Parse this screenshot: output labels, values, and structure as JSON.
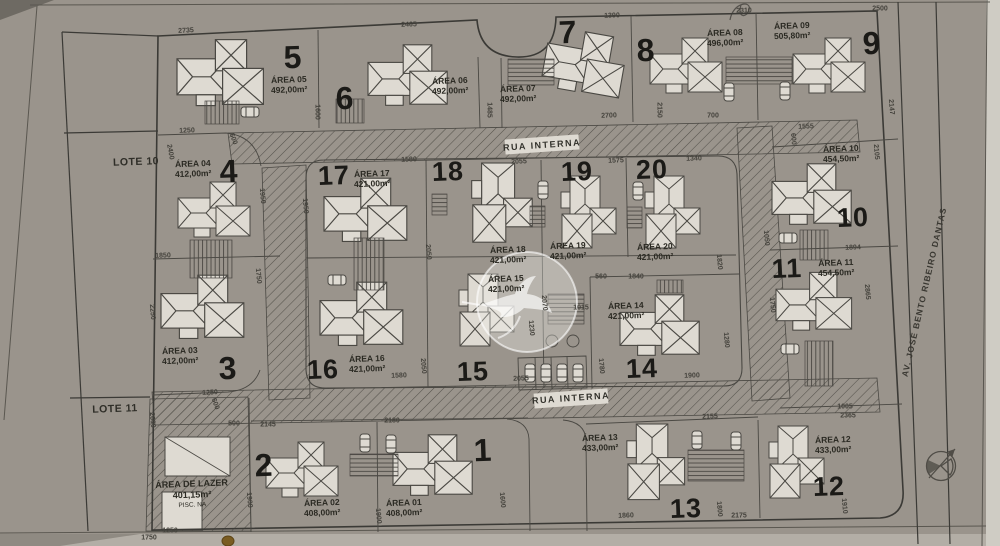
{
  "colors": {
    "paper": "#dedad2",
    "line": "#45433f",
    "ink": "#1b1a17",
    "hatch": "#55524c",
    "dim_text": "#44423c"
  },
  "streets": {
    "rua_interna_top": "RUA INTERNA",
    "rua_interna_bottom": "RUA INTERNA",
    "avenue": "AV. JOSÉ BENTO RIBEIRO DANTAS"
  },
  "neighbors": {
    "lote10": "LOTE 10",
    "lote11": "LOTE 11"
  },
  "leisure": {
    "line1": "ÁREA DE LAZER",
    "line2": "401,15m²",
    "line3": "PISC. NA"
  },
  "icons": {
    "north_arrow": "north-arrow-icon",
    "watermark": "hummingbird-watermark"
  },
  "lots": [
    {
      "num": "1",
      "area_name": "ÁREA 01",
      "area_value": "408,00m²",
      "nx": 483,
      "ny": 450,
      "size": 32,
      "ax": 404,
      "ay": 508
    },
    {
      "num": "2",
      "area_name": "ÁREA 02",
      "area_value": "408,00m²",
      "nx": 264,
      "ny": 465,
      "size": 32,
      "ax": 322,
      "ay": 508
    },
    {
      "num": "3",
      "area_name": "ÁREA 03",
      "area_value": "412,00m²",
      "nx": 228,
      "ny": 368,
      "size": 32,
      "ax": 180,
      "ay": 356
    },
    {
      "num": "4",
      "area_name": "ÁREA 04",
      "area_value": "412,00m²",
      "nx": 229,
      "ny": 171,
      "size": 32,
      "ax": 193,
      "ay": 169
    },
    {
      "num": "5",
      "area_name": "ÁREA 05",
      "area_value": "492,00m²",
      "nx": 293,
      "ny": 57,
      "size": 32,
      "ax": 289,
      "ay": 85
    },
    {
      "num": "6",
      "area_name": "ÁREA 06",
      "area_value": "492,00m²",
      "nx": 345,
      "ny": 98,
      "size": 32,
      "ax": 450,
      "ay": 86
    },
    {
      "num": "7",
      "area_name": "ÁREA 07",
      "area_value": "492,00m²",
      "nx": 568,
      "ny": 32,
      "size": 32,
      "ax": 518,
      "ay": 94
    },
    {
      "num": "8",
      "area_name": "ÁREA 08",
      "area_value": "496,00m²",
      "nx": 646,
      "ny": 50,
      "size": 32,
      "ax": 725,
      "ay": 38
    },
    {
      "num": "9",
      "area_name": "ÁREA 09",
      "area_value": "505,80m²",
      "nx": 872,
      "ny": 43,
      "size": 32,
      "ax": 792,
      "ay": 31
    },
    {
      "num": "10",
      "area_name": "ÁREA 10",
      "area_value": "454,50m²",
      "nx": 853,
      "ny": 218,
      "size": 27,
      "ax": 841,
      "ay": 154
    },
    {
      "num": "11",
      "area_name": "ÁREA 11",
      "area_value": "454,50m²",
      "nx": 787,
      "ny": 269,
      "size": 27,
      "ax": 836,
      "ay": 268
    },
    {
      "num": "12",
      "area_name": "ÁREA 12",
      "area_value": "433,00m²",
      "nx": 829,
      "ny": 487,
      "size": 27,
      "ax": 833,
      "ay": 445
    },
    {
      "num": "13",
      "area_name": "ÁREA 13",
      "area_value": "433,00m²",
      "nx": 686,
      "ny": 509,
      "size": 27,
      "ax": 600,
      "ay": 443
    },
    {
      "num": "14",
      "area_name": "ÁREA 14",
      "area_value": "421,00m²",
      "nx": 642,
      "ny": 369,
      "size": 27,
      "ax": 626,
      "ay": 311
    },
    {
      "num": "15",
      "area_name": "ÁREA 15",
      "area_value": "421,00m²",
      "nx": 473,
      "ny": 372,
      "size": 27,
      "ax": 506,
      "ay": 284
    },
    {
      "num": "16",
      "area_name": "ÁREA 16",
      "area_value": "421,00m²",
      "nx": 323,
      "ny": 370,
      "size": 27,
      "ax": 367,
      "ay": 364
    },
    {
      "num": "17",
      "area_name": "ÁREA 17",
      "area_value": "421,00m²",
      "nx": 334,
      "ny": 176,
      "size": 27,
      "ax": 372,
      "ay": 179
    },
    {
      "num": "18",
      "area_name": "ÁREA 18",
      "area_value": "421,00m²",
      "nx": 448,
      "ny": 172,
      "size": 27,
      "ax": 508,
      "ay": 255
    },
    {
      "num": "19",
      "area_name": "ÁREA 19",
      "area_value": "421,00m²",
      "nx": 577,
      "ny": 172,
      "size": 27,
      "ax": 568,
      "ay": 251
    },
    {
      "num": "20",
      "area_name": "ÁREA 20",
      "area_value": "421,00m²",
      "nx": 652,
      "ny": 170,
      "size": 27,
      "ax": 655,
      "ay": 252
    }
  ],
  "dimensions": [
    [
      "2735",
      186,
      31,
      -3
    ],
    [
      "2465",
      409,
      25,
      -2
    ],
    [
      "1390",
      612,
      16,
      -2
    ],
    [
      "2310",
      744,
      11,
      -1
    ],
    [
      "2500",
      880,
      9,
      0
    ],
    [
      "1250",
      187,
      131,
      -2
    ],
    [
      "1600",
      317,
      112,
      90
    ],
    [
      "1485",
      489,
      110,
      90
    ],
    [
      "2700",
      609,
      116,
      -2
    ],
    [
      "2150",
      659,
      110,
      90
    ],
    [
      "700",
      713,
      116,
      0
    ],
    [
      "1555",
      806,
      127,
      -2
    ],
    [
      "2147",
      891,
      107,
      85
    ],
    [
      "600",
      793,
      139,
      85
    ],
    [
      "2105",
      876,
      152,
      85
    ],
    [
      "600",
      233,
      139,
      70
    ],
    [
      "2400",
      170,
      152,
      80
    ],
    [
      "1950",
      262,
      196,
      85
    ],
    [
      "1950",
      305,
      206,
      85
    ],
    [
      "1850",
      163,
      256,
      -2
    ],
    [
      "2250",
      152,
      312,
      85
    ],
    [
      "1750",
      258,
      276,
      85
    ],
    [
      "1250",
      210,
      393,
      -3
    ],
    [
      "1580",
      409,
      160,
      -2
    ],
    [
      "2055",
      519,
      162,
      -2
    ],
    [
      "1575",
      616,
      161,
      -2
    ],
    [
      "1340",
      694,
      159,
      -2
    ],
    [
      "2050",
      428,
      252,
      85
    ],
    [
      "2050",
      423,
      366,
      85
    ],
    [
      "1580",
      399,
      376,
      -2
    ],
    [
      "2055",
      521,
      379,
      -2
    ],
    [
      "560",
      601,
      277,
      0
    ],
    [
      "1840",
      636,
      277,
      0
    ],
    [
      "1015",
      581,
      308,
      0
    ],
    [
      "2070",
      544,
      303,
      85
    ],
    [
      "1230",
      531,
      328,
      85
    ],
    [
      "1780",
      601,
      366,
      85
    ],
    [
      "1820",
      719,
      262,
      85
    ],
    [
      "1280",
      726,
      340,
      85
    ],
    [
      "1900",
      692,
      376,
      -2
    ],
    [
      "1894",
      853,
      248,
      -2
    ],
    [
      "2865",
      867,
      292,
      85
    ],
    [
      "1750",
      772,
      305,
      85
    ],
    [
      "1050",
      766,
      238,
      85
    ],
    [
      "1005",
      845,
      407,
      0
    ],
    [
      "2365",
      848,
      416,
      0
    ],
    [
      "1910",
      844,
      506,
      85
    ],
    [
      "2155",
      710,
      417,
      -2
    ],
    [
      "1860",
      626,
      516,
      -2
    ],
    [
      "1800",
      719,
      509,
      85
    ],
    [
      "2175",
      739,
      516,
      0
    ],
    [
      "500",
      234,
      424,
      0
    ],
    [
      "2145",
      268,
      425,
      0
    ],
    [
      "2180",
      392,
      421,
      0
    ],
    [
      "1900",
      378,
      516,
      85
    ],
    [
      "1600",
      502,
      500,
      85
    ],
    [
      "2600",
      152,
      420,
      85
    ],
    [
      "600",
      215,
      404,
      70
    ],
    [
      "1250",
      170,
      531,
      0
    ],
    [
      "1750",
      149,
      538,
      0
    ],
    [
      "1900",
      249,
      500,
      85
    ]
  ],
  "drawing": {
    "houses": [
      [
        437,
        470,
        1.1,
        0
      ],
      [
        306,
        474,
        1.0,
        0
      ],
      [
        207,
        312,
        1.15,
        0
      ],
      [
        218,
        214,
        1.0,
        0
      ],
      [
        225,
        78,
        1.2,
        0
      ],
      [
        412,
        80,
        1.1,
        0
      ],
      [
        588,
        68,
        1.1,
        10
      ],
      [
        690,
        70,
        1.0,
        0
      ],
      [
        833,
        70,
        1.0,
        0
      ],
      [
        816,
        199,
        1.1,
        0
      ],
      [
        818,
        306,
        1.05,
        0
      ],
      [
        792,
        466,
        1.0,
        90
      ],
      [
        651,
        466,
        1.05,
        90
      ],
      [
        664,
        330,
        1.1,
        0
      ],
      [
        482,
        314,
        1.0,
        90
      ],
      [
        366,
        319,
        1.15,
        0
      ],
      [
        370,
        215,
        1.15,
        0
      ],
      [
        497,
        207,
        1.1,
        90
      ],
      [
        584,
        216,
        1.0,
        90
      ],
      [
        668,
        216,
        1.0,
        90
      ]
    ],
    "cars": [
      [
        365,
        443,
        0
      ],
      [
        391,
        444,
        0
      ],
      [
        250,
        112,
        90
      ],
      [
        543,
        190,
        0
      ],
      [
        638,
        191,
        0
      ],
      [
        729,
        92,
        0
      ],
      [
        785,
        91,
        0
      ],
      [
        788,
        238,
        90
      ],
      [
        790,
        349,
        90
      ],
      [
        697,
        440,
        0
      ],
      [
        736,
        441,
        0
      ],
      [
        337,
        280,
        90
      ],
      [
        530,
        373,
        0
      ],
      [
        546,
        373,
        0
      ],
      [
        562,
        373,
        0
      ],
      [
        578,
        373,
        0
      ]
    ],
    "stripes": [
      [
        205,
        101,
        34,
        23,
        "V"
      ],
      [
        336,
        99,
        28,
        24,
        "V"
      ],
      [
        508,
        59,
        46,
        26,
        "H"
      ],
      [
        726,
        57,
        66,
        27,
        "H"
      ],
      [
        190,
        240,
        42,
        38,
        "V"
      ],
      [
        354,
        238,
        30,
        52,
        "V"
      ],
      [
        432,
        194,
        15,
        21,
        "H"
      ],
      [
        530,
        206,
        15,
        21,
        "H"
      ],
      [
        627,
        207,
        15,
        21,
        "H"
      ],
      [
        800,
        230,
        28,
        30,
        "V"
      ],
      [
        805,
        341,
        28,
        45,
        "V"
      ],
      [
        657,
        280,
        26,
        13,
        "V"
      ],
      [
        350,
        454,
        48,
        22,
        "H"
      ],
      [
        688,
        450,
        56,
        31,
        "H"
      ],
      [
        548,
        294,
        36,
        30,
        "H"
      ]
    ]
  }
}
